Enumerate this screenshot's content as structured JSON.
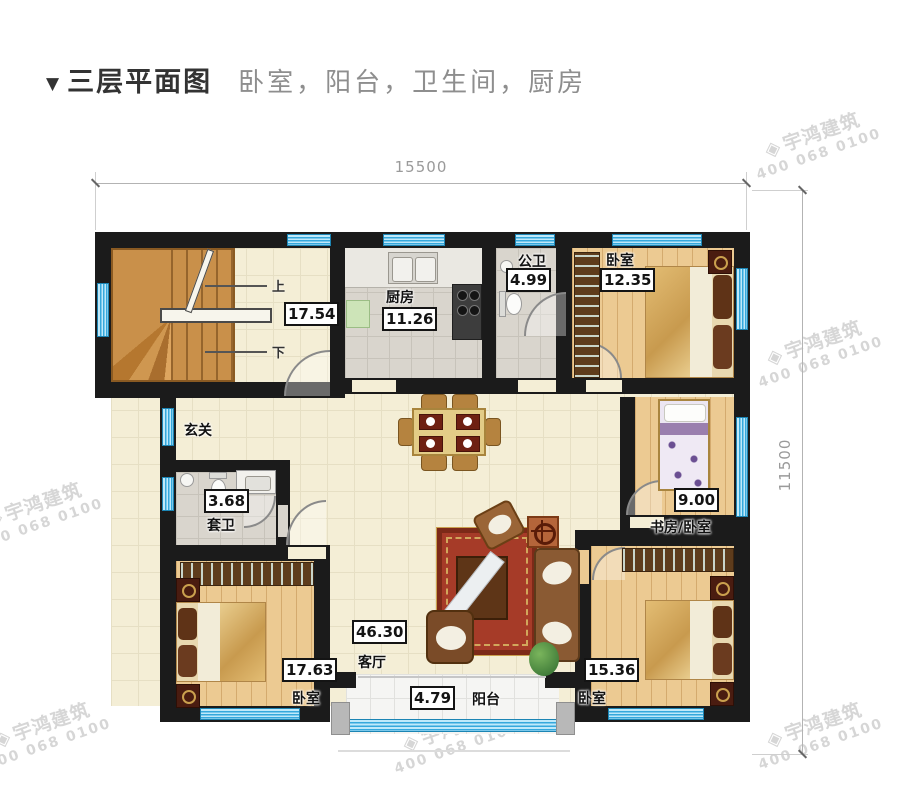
{
  "header": {
    "marker": "▼",
    "title": "三层平面图",
    "subtitle": "卧室，阳台，卫生间，厨房"
  },
  "dims": {
    "width": "15500",
    "height": "11500"
  },
  "stairs": {
    "up": "上",
    "down": "下",
    "area": "17.54"
  },
  "rooms": {
    "kitchen": {
      "name": "厨房",
      "area": "11.26"
    },
    "public_bath": {
      "name": "公卫",
      "area": "4.99"
    },
    "bedroom_ne": {
      "name": "卧室",
      "area": "12.35"
    },
    "entry": {
      "name": "玄关"
    },
    "suite_bath": {
      "name": "套卫",
      "area": "3.68"
    },
    "study": {
      "name": "书房/卧室",
      "area": "9.00"
    },
    "living": {
      "name": "客厅",
      "area": "46.30"
    },
    "bedroom_sw": {
      "name": "卧室",
      "area": "17.63"
    },
    "balcony": {
      "name": "阳台",
      "area": "4.79"
    },
    "bedroom_se": {
      "name": "卧室",
      "area": "15.36"
    }
  },
  "watermark": {
    "logo": "◈",
    "brand": "宇鸿建筑",
    "phone": "400 068 0100"
  },
  "colors": {
    "wall": "#1b1b1b",
    "window_blue": "#41b1e2",
    "floor_cream": "#f4eed6",
    "floor_wood": "#ecca92",
    "tile_gray": "#d9d5cd",
    "rug_red": "#a63b28",
    "title_text": "#333333",
    "subtitle_text": "#8e8e8e",
    "dimension_text": "#9a9a9a",
    "watermark_gray": "#d4d4d4"
  }
}
